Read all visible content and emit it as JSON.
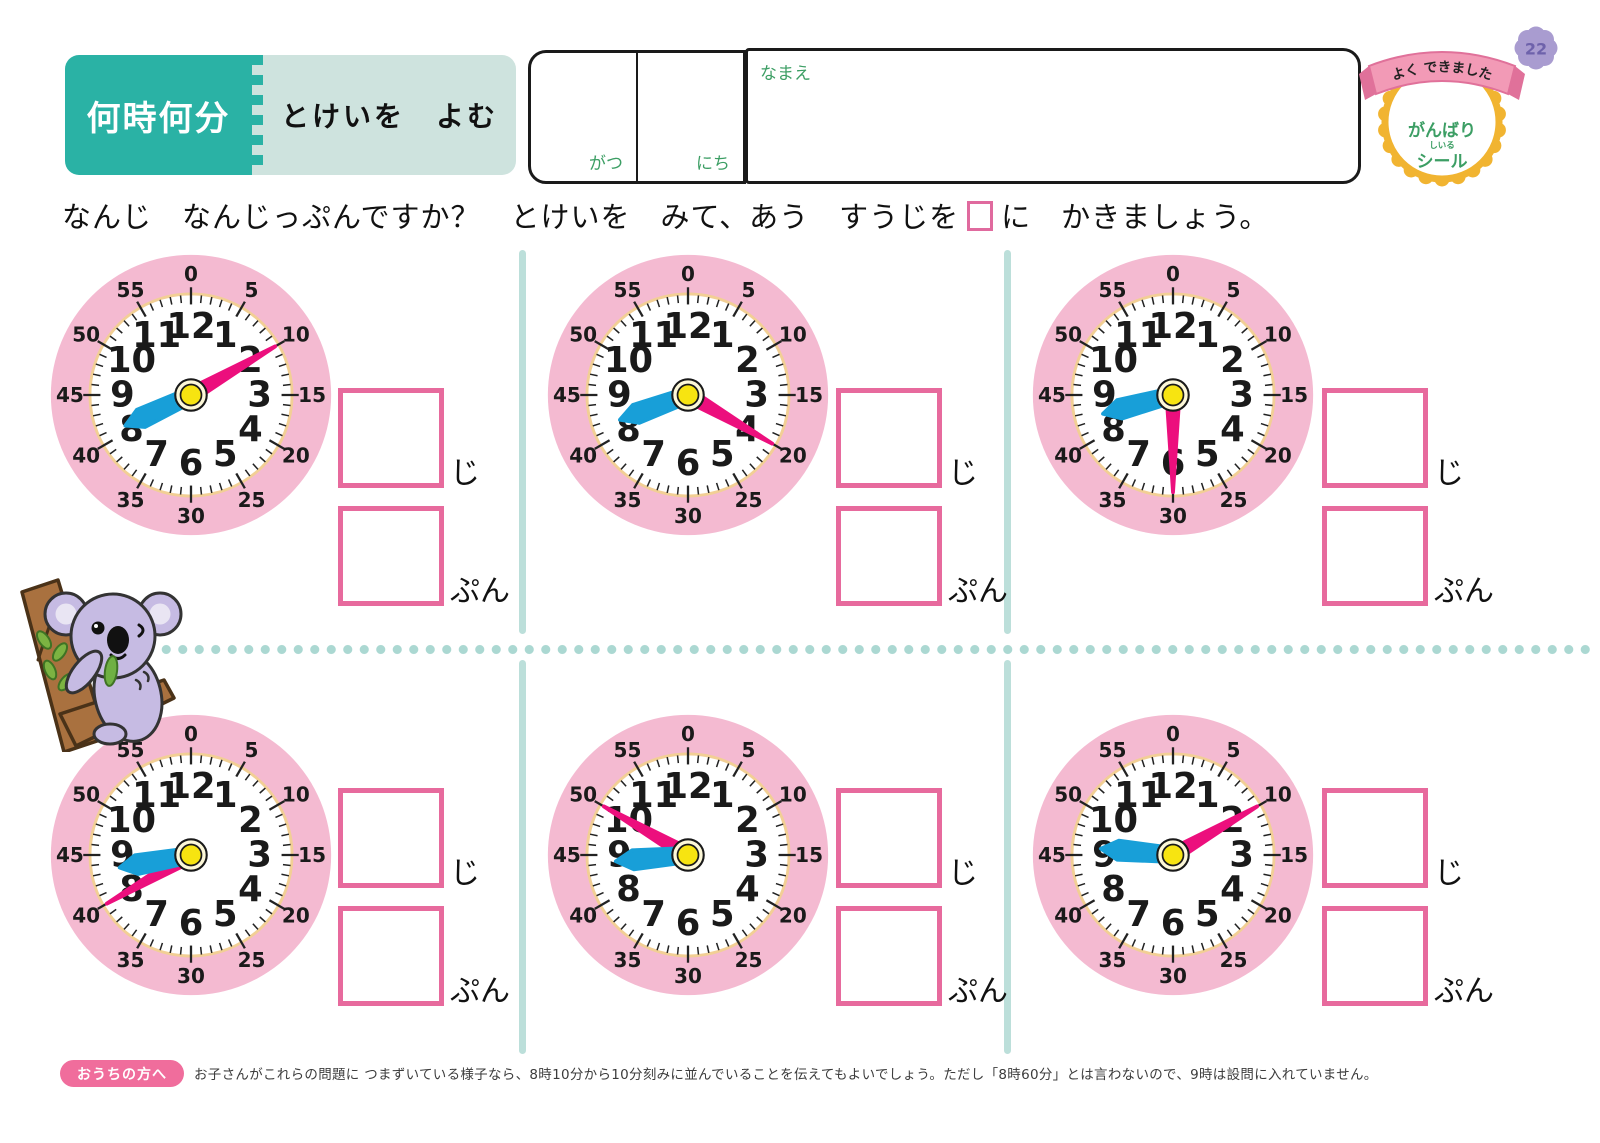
{
  "page": {
    "number": "22"
  },
  "header": {
    "unit_title": "何時何分",
    "lesson_title": "とけいを　よむ",
    "date": {
      "month_label": "がつ",
      "day_label": "にち"
    },
    "name_label": "なまえ",
    "reward_badge": {
      "ribbon": "よく できました",
      "line1": "がんばり",
      "furigana": "しいる",
      "line2": "シール"
    }
  },
  "instruction": {
    "before_box": "なんじ　なんじっぷんですか？　とけいを　みて、あう　すうじを",
    "after_box": "に　かきましょう。"
  },
  "answer_labels": {
    "hour": "じ",
    "minute": "ぷん"
  },
  "clock_face": {
    "minute_numbers": [
      "0",
      "5",
      "10",
      "15",
      "20",
      "25",
      "30",
      "35",
      "40",
      "45",
      "50",
      "55"
    ],
    "hour_numbers": [
      "12",
      "1",
      "2",
      "3",
      "4",
      "5",
      "6",
      "7",
      "8",
      "9",
      "10",
      "11"
    ]
  },
  "clocks": [
    {
      "time": "8:10",
      "hour": 8,
      "minute": 10
    },
    {
      "time": "8:20",
      "hour": 8,
      "minute": 20
    },
    {
      "time": "8:30",
      "hour": 8,
      "minute": 30
    },
    {
      "time": "8:40",
      "hour": 8,
      "minute": 40
    },
    {
      "time": "8:50",
      "hour": 8,
      "minute": 50
    },
    {
      "time": "9:10",
      "hour": 9,
      "minute": 10
    }
  ],
  "footer": {
    "badge": "おうちの方へ",
    "note": "お子さんがこれらの問題に つまずいている様子なら、8時10分から10分刻みに並んでいることを伝えてもよいでしょう。ただし「8時60分」とは言わないので、9時は設問に入れていません。"
  },
  "colors": {
    "teal": "#2ab2a5",
    "light_teal": "#cee3de",
    "green": "#3c9e64",
    "clock_rim": "#f4bad1",
    "face_ring": "#f2cf95",
    "hand_blue": "#189fd8",
    "hand_pink": "#ec0f7d",
    "center_yellow": "#f7e411",
    "box_pink": "#e76a9d",
    "divider_teal": "#bcdfda",
    "dot_teal": "#abd8d2",
    "badge_yellow": "#f1b431",
    "ribbon_pink": "#f29ab6",
    "page_badge_purple": "#a99cd0",
    "footer_pink": "#f06d9c"
  }
}
